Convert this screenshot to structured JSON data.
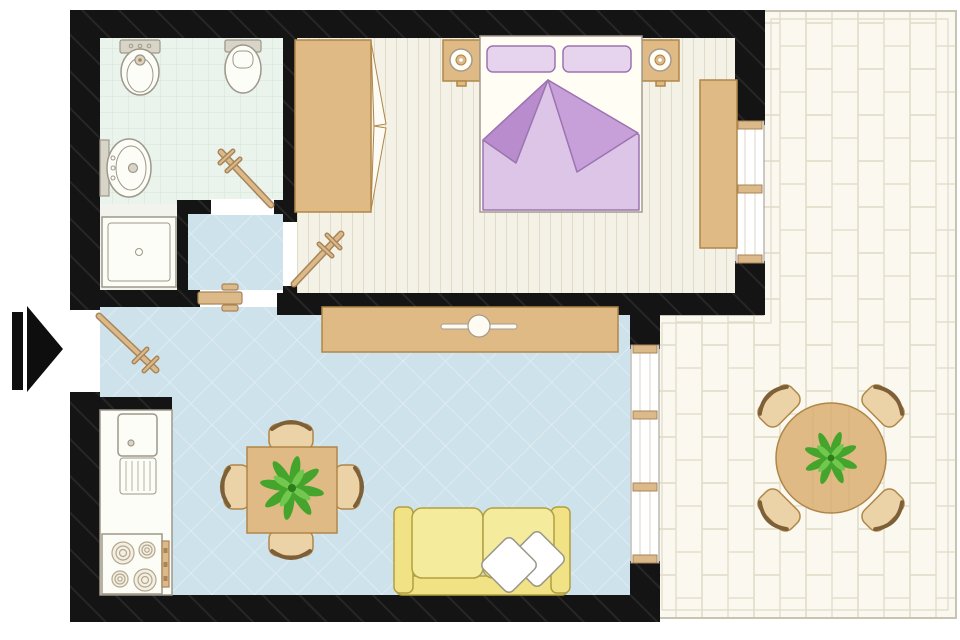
{
  "title": "apartment-floor-plan",
  "colors": {
    "wall": "#141414",
    "bathFloor": "#eaf3ec",
    "bathTile": "#d3e5d6",
    "showerFloor": "#f3f3ee",
    "bedFloor": "#f4f1e7",
    "bedPlank": "#e1dcc8",
    "livingFloor": "#cee2eb",
    "livingLine": "#e2eef3",
    "terraceFloor": "#faf8ef",
    "terraceBrick": "#e3deca",
    "terraceBorder": "#c9c4b2",
    "wood": "#dfba85",
    "woodStroke": "#b08648",
    "woodDark": "#7d5f38",
    "woodLight": "#ecd3a7",
    "doorTan": "#dcb988",
    "doorStroke": "#a8845a",
    "fixtureFill": "#fdfdf8",
    "fixtureStroke": "#9d9889",
    "tankFill": "#d8d4c8",
    "bedFrame": "#fffdf4",
    "bedFrameStroke": "#a59a8e",
    "pillowFill": "#e6d4ee",
    "purpleLight": "#dcc5e6",
    "purpleMid": "#c7a0da",
    "purpleDark": "#b88ccd",
    "purpleStroke": "#9b74b0",
    "sofaFill": "#f1e285",
    "sofaCushion": "#f5eb9c",
    "sofaStroke": "#b1a042",
    "plantGreen": "#45a42c",
    "plantLight": "#72c84e",
    "plantDark": "#2e7d1b",
    "arrow": "#0e0e0e"
  },
  "rooms": [
    {
      "name": "bathroom",
      "floor": "green-tile-grid",
      "fixtures": [
        "bidet",
        "toilet",
        "wash-basin",
        "shower-tray",
        "swing-door"
      ]
    },
    {
      "name": "hallway",
      "floor": "blue-diamond",
      "fixtures": [
        "open-door-to-living-room",
        "swing-door-to-bedroom"
      ]
    },
    {
      "name": "bedroom",
      "floor": "wood-planks-vertical",
      "fixtures": [
        "wardrobe-with-open-doors",
        "double-bed",
        "pillows-x2",
        "folded-blanket",
        "nightstand-left",
        "lamp-left",
        "nightstand-right",
        "lamp-right",
        "dresser",
        "window"
      ]
    },
    {
      "name": "living-room-with-kitchen",
      "floor": "blue-diamond",
      "fixtures": [
        "kitchen-counter",
        "kitchen-sink",
        "drainboard",
        "stove-4-burners",
        "sideboard-with-knob",
        "dining-table-with-plant",
        "dining-chairs-x4",
        "sofa-yellow",
        "sofa-pillows-x2",
        "window-to-terrace",
        "entry-door"
      ]
    },
    {
      "name": "terrace",
      "floor": "brick-paving-vertical",
      "fixtures": [
        "round-table-with-plant",
        "terrace-chairs-x4",
        "railing-border"
      ]
    }
  ],
  "entry_indicator": "black-arrow-pointing-right"
}
